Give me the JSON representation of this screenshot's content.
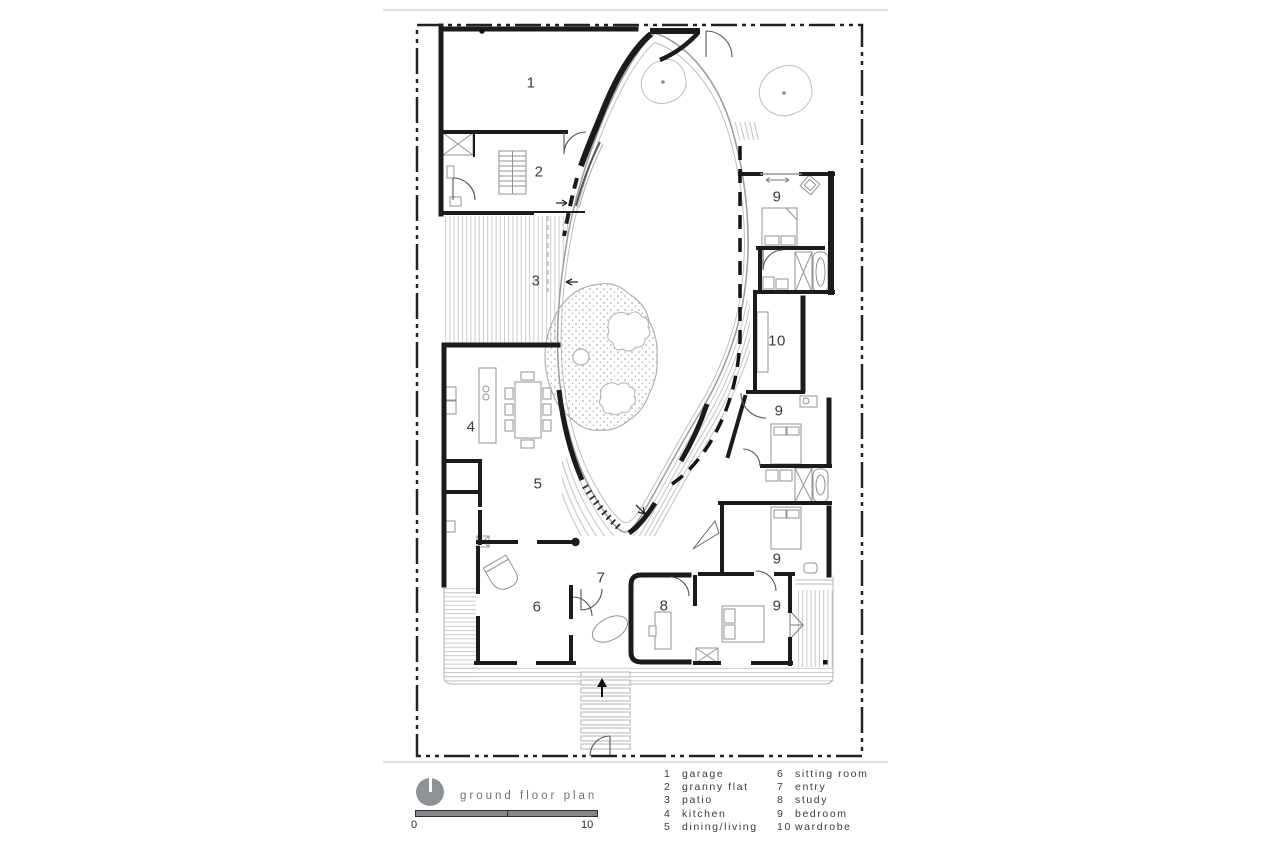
{
  "plan": {
    "room_labels": [
      {
        "num": "1",
        "room": "garage"
      },
      {
        "num": "2",
        "room": "granny flat"
      },
      {
        "num": "3",
        "room": "patio"
      },
      {
        "num": "4",
        "room": "kitchen"
      },
      {
        "num": "5",
        "room": "dining/living"
      },
      {
        "num": "6",
        "room": "sitting room"
      },
      {
        "num": "7",
        "room": "entry"
      },
      {
        "num": "8",
        "room": "study"
      },
      {
        "num": "9",
        "room": "bedroom"
      },
      {
        "num": "10",
        "room": "wardrobe"
      },
      {
        "num": "9",
        "room": "bedroom"
      },
      {
        "num": "9",
        "room": "bedroom"
      },
      {
        "num": "9",
        "room": "bedroom"
      }
    ]
  },
  "legend": {
    "title": "ground floor plan",
    "scale": {
      "start": "0",
      "end": "10"
    },
    "columns": [
      {
        "items": [
          {
            "num": "1",
            "label": "garage"
          },
          {
            "num": "2",
            "label": "granny flat"
          },
          {
            "num": "3",
            "label": "patio"
          },
          {
            "num": "4",
            "label": "kitchen"
          },
          {
            "num": "5",
            "label": "dining/living"
          }
        ]
      },
      {
        "items": [
          {
            "num": "6",
            "label": "sitting room"
          },
          {
            "num": "7",
            "label": "entry"
          },
          {
            "num": "8",
            "label": "study"
          },
          {
            "num": "9",
            "label": "bedroom"
          },
          {
            "num": "10",
            "label": "wardrobe"
          }
        ]
      }
    ]
  }
}
